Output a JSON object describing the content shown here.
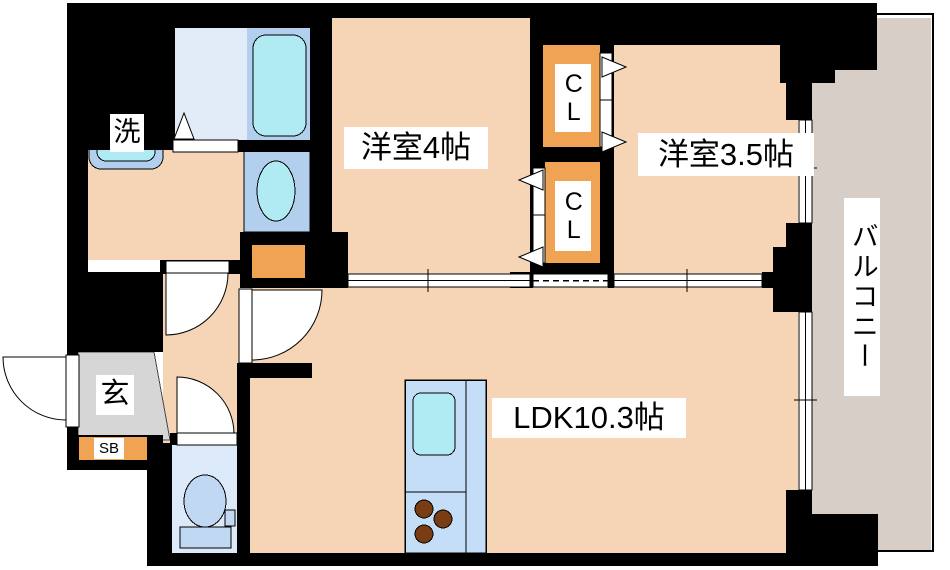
{
  "plan": {
    "title": "1LDK apartment floor plan",
    "labels": {
      "washer": "洗",
      "room4": "洋室4帖",
      "closet_upper": "CL",
      "closet_lower": "CL",
      "room35": "洋室3.5帖",
      "balcony": "バルコニー",
      "ldk": "LDK10.3帖",
      "entrance": "玄",
      "shoe_box": "SB"
    },
    "colors": {
      "wall": "#000000",
      "room_floor": "#f5d5b6",
      "closet_orange": "#f0a352",
      "balcony_gray": "#d7cfc7",
      "entrance_gray": "#d6d6d6",
      "bath_floor": "#e2ebf8",
      "fixture_blue": "#b2d0ee",
      "water_cyan": "#b0eaf3",
      "toilet_floor": "#dce9f8",
      "toilet_fixture": "#c0d8f2",
      "kitchen_blue": "#c5def7",
      "burner_brown": "#7a3c12"
    }
  }
}
